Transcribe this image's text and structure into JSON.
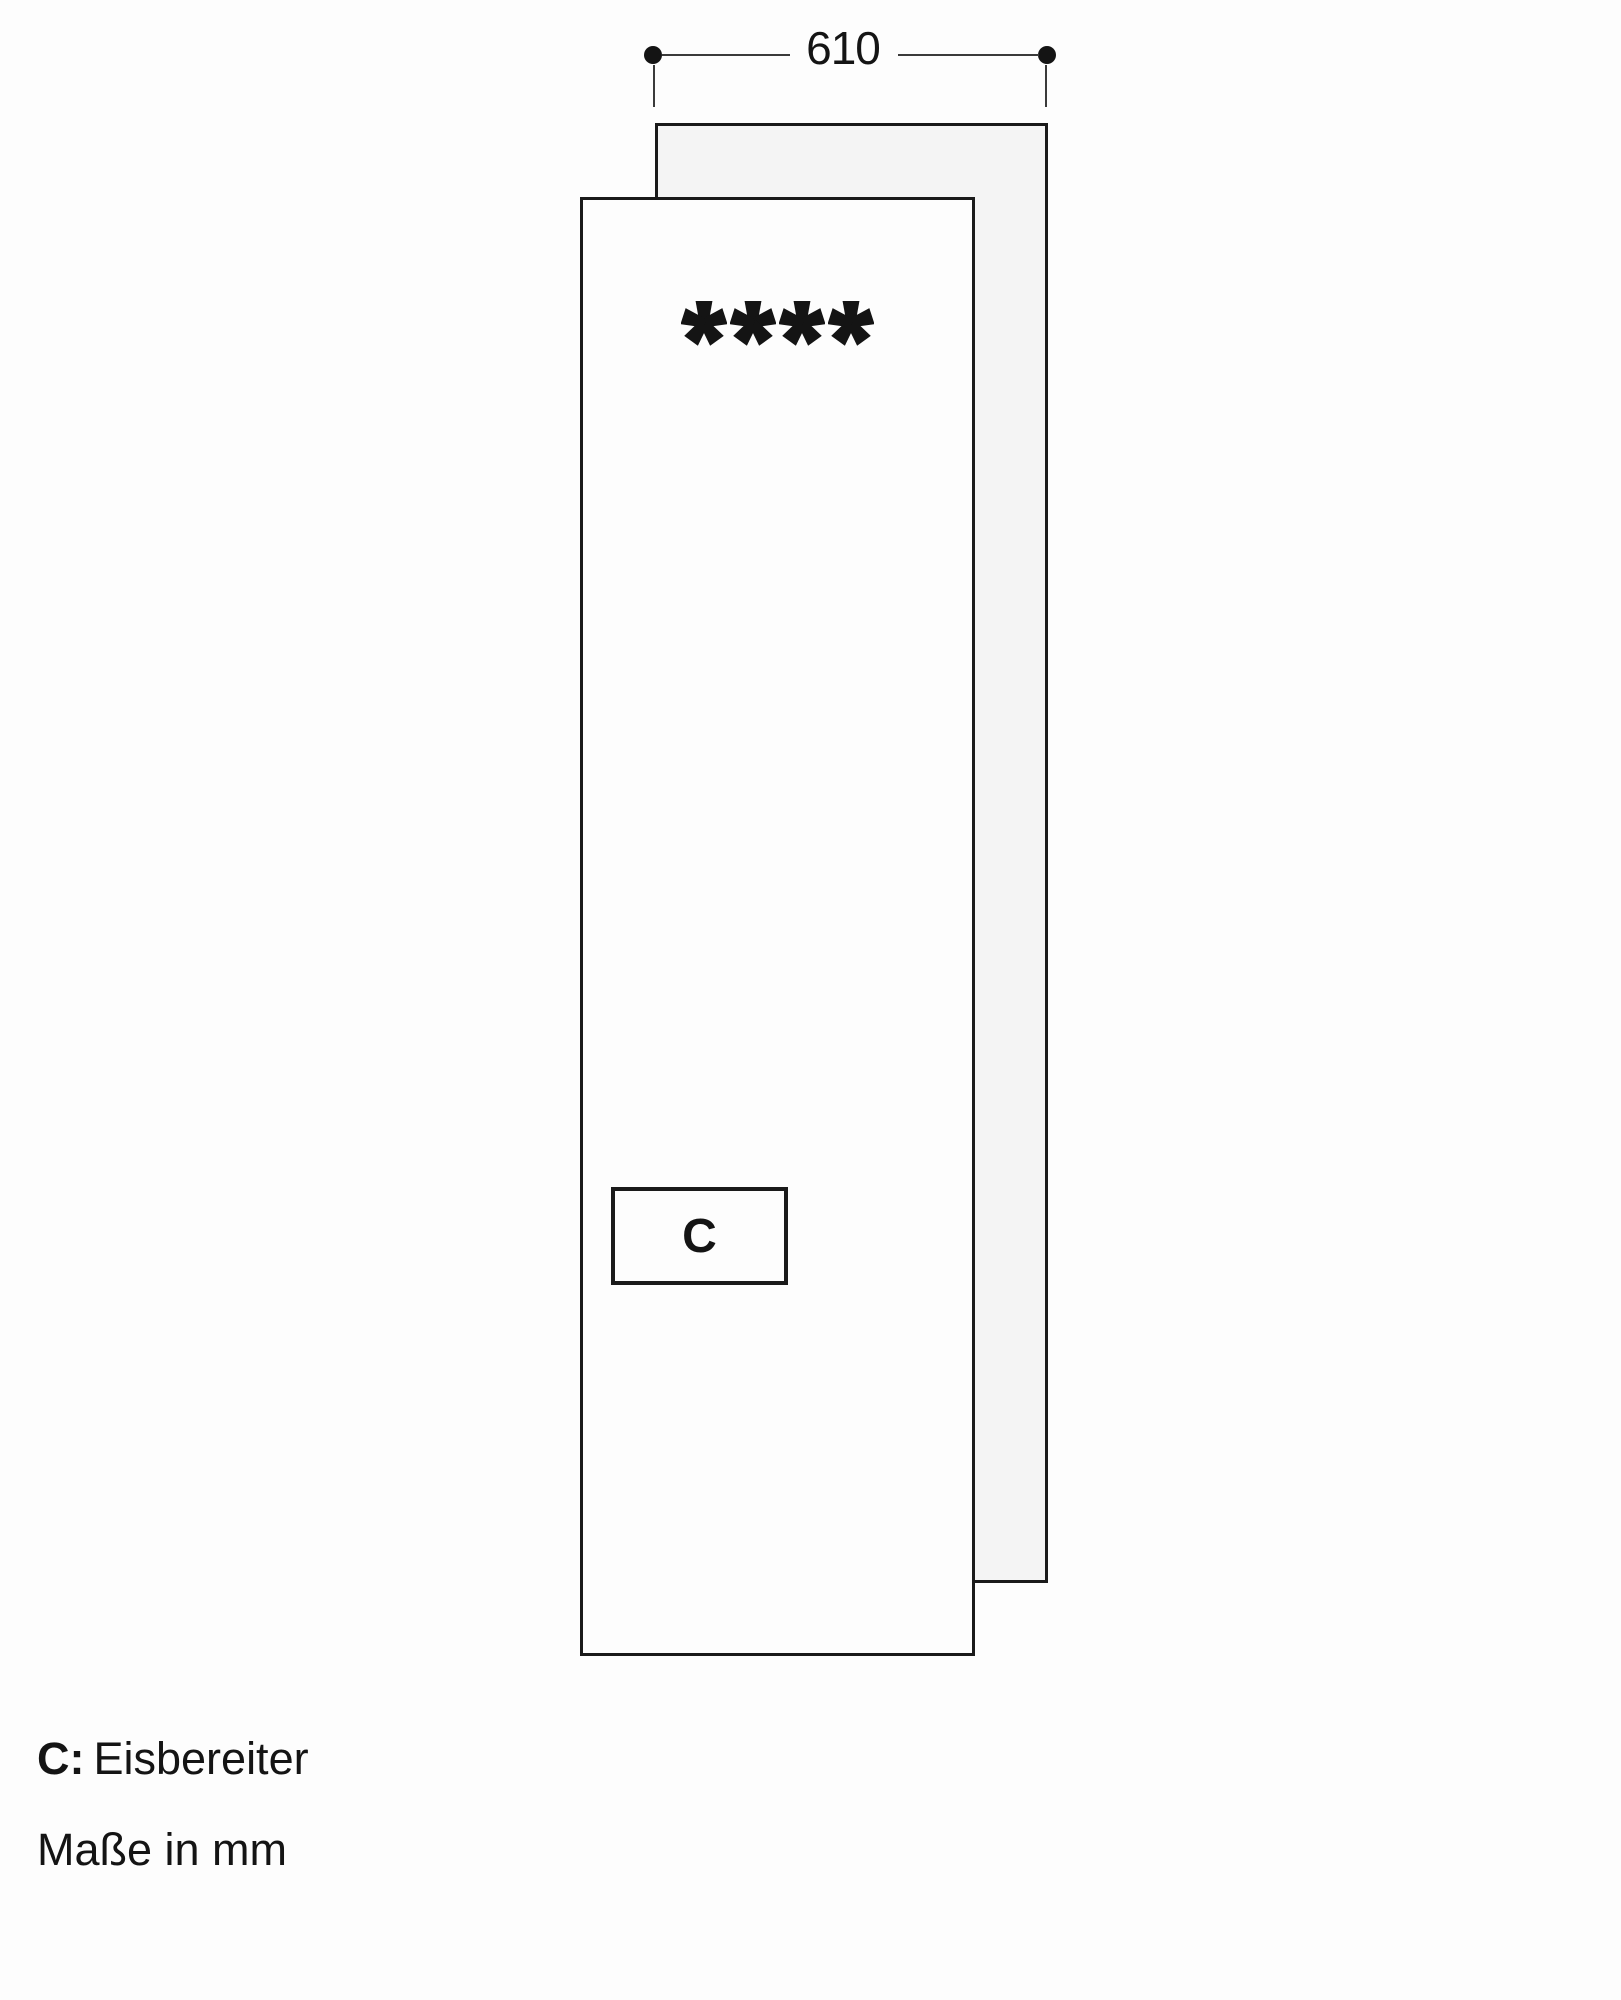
{
  "dimension": {
    "width_label": "610"
  },
  "panels": {
    "freezer_star_count": 4,
    "freezer_star_symbol": "✱✱✱✱"
  },
  "ice_maker_box": {
    "label": "C"
  },
  "legend": {
    "key": "C:",
    "label": "Eisbereiter"
  },
  "note": "Maße in mm",
  "colors": {
    "line": "#1a1a1a",
    "dimension_line": "#3a3a3a",
    "rear_panel_fill": "#f4f4f4",
    "background": "#fdfdfd"
  }
}
